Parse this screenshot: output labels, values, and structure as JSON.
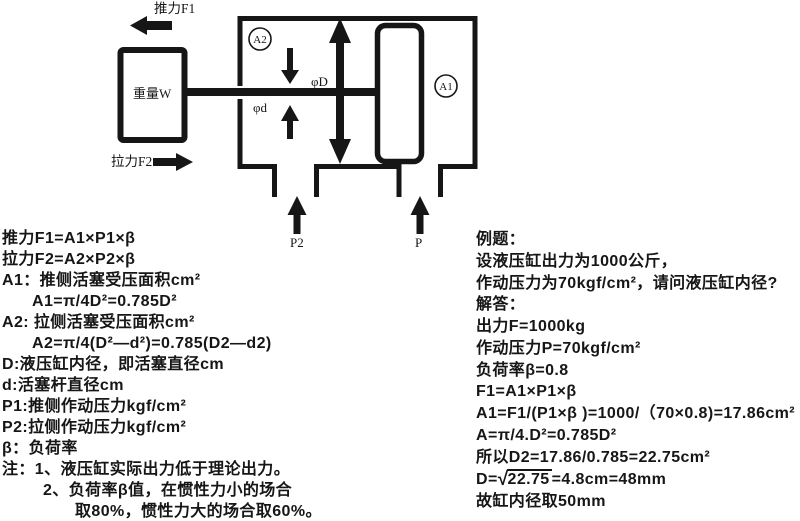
{
  "colors": {
    "ink": "#161616",
    "background": "#ffffff"
  },
  "diagram": {
    "push_label": "推力F1",
    "weight_label": "重量W",
    "pull_label": "拉力F2",
    "area_pull_label": "A2",
    "area_push_label": "A1",
    "bore_label": "φD",
    "rod_label": "φd",
    "port_pull_label": "P2",
    "port_push_label": "P"
  },
  "formulas": {
    "lines": [
      "推力F1=A1×P1×β",
      "拉力F2=A2×P2×β",
      "A1：推侧活塞受压面积cm²",
      "A1=π/4D²=0.785D²",
      "A2: 拉侧活塞受压面积cm²",
      "A2=π/4(D²—d²)=0.785(D2—d2)",
      "D:液压缸内径，即活塞直径cm",
      "d:活塞杆直径cm",
      "P1:推侧作动压力kgf/cm²",
      "P2:拉侧作动压力kgf/cm²",
      "β：负荷率",
      "注：1、液压缸实际出力低于理论出力。",
      "2、负荷率β值，在惯性力小的场合",
      "取80%，惯性力大的场合取60%。"
    ]
  },
  "example": {
    "lines": [
      "例题：",
      "设液压缸出力为1000公斤，",
      "作动压力为70kgf/cm²，请问液压缸内径?",
      "解答：",
      "出力F=1000kg",
      "作动压力P=70kgf/cm²",
      "负荷率β=0.8",
      "F1=A1×P1×β",
      "A1=F1/(P1×β )=1000/（70×0.8)=17.86cm²",
      "A=π/4.D²=0.785D²",
      "所以D2=17.86/0.785=22.75cm²"
    ],
    "radical": {
      "pre": "D=",
      "sign": "√",
      "num": "22.75",
      "post": "=4.8cm=48mm"
    },
    "last_line": "故缸内径取50mm"
  }
}
